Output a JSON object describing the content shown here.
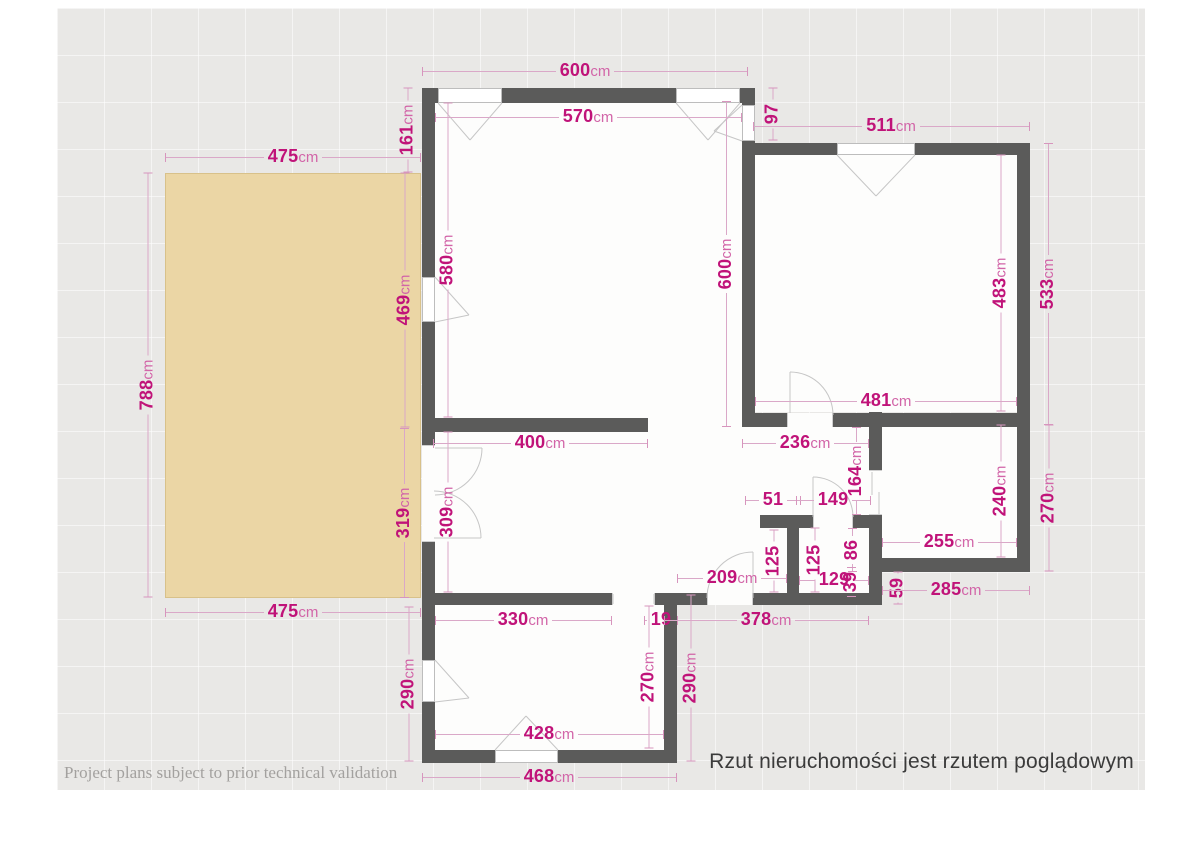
{
  "canvas": {
    "x": 57,
    "y": 8,
    "w": 1088,
    "h": 782
  },
  "colors": {
    "background": "#ffffff",
    "canvas_bg": "#e9e8e6",
    "grid": "rgba(255,255,255,0.55)",
    "wall": "#5b5b5a",
    "room_floor": "#fdfdfc",
    "terrace": "#ebd6a5",
    "dim_number": "#c01379",
    "dim_unit": "#d265a8",
    "dim_line": "#daa8c8",
    "opening_line": "#c6c6c6"
  },
  "terrace": {
    "x": 165,
    "y": 173,
    "w": 256,
    "h": 425
  },
  "floors": [
    {
      "x": 435,
      "y": 103,
      "w": 307,
      "h": 315
    },
    {
      "x": 648,
      "y": 418,
      "w": 94,
      "h": 14
    },
    {
      "x": 435,
      "y": 427,
      "w": 434,
      "h": 166
    },
    {
      "x": 755,
      "y": 155,
      "w": 262,
      "h": 257
    },
    {
      "x": 882,
      "y": 425,
      "w": 135,
      "h": 133
    },
    {
      "x": 435,
      "y": 605,
      "w": 229,
      "h": 145
    }
  ],
  "walls": [
    {
      "x": 422,
      "y": 88,
      "w": 326,
      "h": 15
    },
    {
      "x": 422,
      "y": 88,
      "w": 13,
      "h": 675
    },
    {
      "x": 422,
      "y": 750,
      "w": 255,
      "h": 13
    },
    {
      "x": 664,
      "y": 593,
      "w": 13,
      "h": 170
    },
    {
      "x": 422,
      "y": 418,
      "w": 226,
      "h": 14
    },
    {
      "x": 422,
      "y": 593,
      "w": 190,
      "h": 12
    },
    {
      "x": 655,
      "y": 593,
      "w": 214,
      "h": 12
    },
    {
      "x": 742,
      "y": 88,
      "w": 13,
      "h": 339
    },
    {
      "x": 753,
      "y": 143,
      "w": 277,
      "h": 12
    },
    {
      "x": 1017,
      "y": 143,
      "w": 13,
      "h": 429
    },
    {
      "x": 755,
      "y": 413,
      "w": 262,
      "h": 14
    },
    {
      "x": 869,
      "y": 412,
      "w": 13,
      "h": 193
    },
    {
      "x": 869,
      "y": 558,
      "w": 161,
      "h": 14
    },
    {
      "x": 760,
      "y": 515,
      "w": 53,
      "h": 13
    },
    {
      "x": 853,
      "y": 515,
      "w": 16,
      "h": 13
    },
    {
      "x": 787,
      "y": 515,
      "w": 12,
      "h": 90
    }
  ],
  "windows": [
    {
      "name": "window-living-north-1",
      "x": 438,
      "y": 88,
      "w": 64,
      "h": 15,
      "edge": "bottom",
      "tip": [
        470,
        140
      ]
    },
    {
      "name": "window-living-north-2",
      "x": 676,
      "y": 88,
      "w": 64,
      "h": 15,
      "edge": "bottom",
      "tip": [
        708,
        140
      ]
    },
    {
      "name": "window-living-east",
      "x": 742,
      "y": 105,
      "w": 13,
      "h": 36,
      "edge": "left",
      "tip": [
        714,
        131
      ]
    },
    {
      "name": "window-bedroom-north",
      "x": 837,
      "y": 143,
      "w": 78,
      "h": 12,
      "edge": "bottom",
      "tip": [
        876,
        196
      ]
    },
    {
      "name": "window-living-west",
      "x": 422,
      "y": 277,
      "w": 13,
      "h": 45,
      "edge": "right",
      "tip": [
        469,
        315
      ]
    },
    {
      "name": "window-bottomroom-west",
      "x": 422,
      "y": 660,
      "w": 13,
      "h": 42,
      "edge": "right",
      "tip": [
        469,
        698
      ]
    },
    {
      "name": "window-bottomroom-south",
      "x": 495,
      "y": 750,
      "w": 63,
      "h": 13,
      "edge": "top",
      "tip": [
        526,
        716
      ]
    }
  ],
  "doors": [
    {
      "name": "door-terrace-french-gap",
      "gap": {
        "x": 422,
        "y": 445,
        "w": 13,
        "h": 97,
        "dir": "v"
      },
      "leaf": [
        435,
        448,
        482,
        448
      ],
      "arc": "M482 448 A47 47 0 0 1 435 495"
    },
    {
      "name": "door-terrace-french-leaf2",
      "gap": null,
      "leaf": [
        434,
        538,
        481,
        538
      ],
      "arc": "M481 538 A47 47 0 0 0 434 491"
    },
    {
      "name": "door-bedroom",
      "gap": {
        "x": 787,
        "y": 413,
        "w": 46,
        "h": 14,
        "dir": "h"
      },
      "leaf": [
        790,
        413,
        790,
        372
      ],
      "arc": "M790 372 A43 43 0 0 1 833 415"
    },
    {
      "name": "door-wc",
      "gap": {
        "x": 813,
        "y": 515,
        "w": 40,
        "h": 13,
        "dir": "h"
      },
      "leaf": [
        813,
        517,
        813,
        477
      ],
      "arc": "M813 477 A40 40 0 0 1 853 517"
    },
    {
      "name": "door-entrance",
      "gap": {
        "x": 707,
        "y": 593,
        "w": 46,
        "h": 12,
        "dir": "h"
      },
      "leaf": [
        753,
        598,
        753,
        552
      ],
      "arc": "M707 598 A46 46 0 0 1 753 552"
    },
    {
      "name": "opening-bottom-room",
      "gap": {
        "x": 612,
        "y": 593,
        "w": 43,
        "h": 12,
        "dir": "h"
      },
      "leaf": null,
      "arc": null
    },
    {
      "name": "closet-sliding",
      "gap": {
        "x": 869,
        "y": 470,
        "w": 13,
        "h": 45,
        "dir": "v"
      },
      "leaf": null,
      "arc": null
    }
  ],
  "marks": [
    [
      613,
      594,
      613,
      604
    ],
    [
      654,
      594,
      654,
      604
    ],
    [
      872,
      472,
      872,
      495
    ],
    [
      879,
      492,
      879,
      514
    ]
  ],
  "dimensions": [
    {
      "v": "600",
      "u": "cm",
      "o": "h",
      "x": 585,
      "y": 71,
      "l": 326
    },
    {
      "v": "570",
      "u": "cm",
      "o": "h",
      "x": 588,
      "y": 117,
      "l": 307
    },
    {
      "v": "475",
      "u": "cm",
      "o": "h",
      "x": 293,
      "y": 157,
      "l": 256
    },
    {
      "v": "511",
      "u": "cm",
      "o": "h",
      "x": 891,
      "y": 126,
      "l": 277
    },
    {
      "v": "161",
      "u": "cm",
      "o": "v",
      "x": 407,
      "y": 130,
      "l": 85
    },
    {
      "v": "97",
      "u": "",
      "o": "v",
      "x": 772,
      "y": 114,
      "l": 53
    },
    {
      "v": "580",
      "u": "cm",
      "o": "v",
      "x": 447,
      "y": 260,
      "l": 315
    },
    {
      "v": "469",
      "u": "cm",
      "o": "v",
      "x": 404,
      "y": 300,
      "l": 255
    },
    {
      "v": "600",
      "u": "cm",
      "o": "v",
      "x": 726,
      "y": 264,
      "l": 326
    },
    {
      "v": "483",
      "u": "cm",
      "o": "v",
      "x": 1000,
      "y": 283,
      "l": 257
    },
    {
      "v": "533",
      "u": "cm",
      "o": "v",
      "x": 1048,
      "y": 284,
      "l": 282
    },
    {
      "v": "788",
      "u": "cm",
      "o": "v",
      "x": 147,
      "y": 385,
      "l": 425
    },
    {
      "v": "475",
      "u": "cm",
      "o": "h",
      "x": 293,
      "y": 612,
      "l": 256
    },
    {
      "v": "400",
      "u": "cm",
      "o": "h",
      "x": 540,
      "y": 443,
      "l": 215
    },
    {
      "v": "481",
      "u": "cm",
      "o": "h",
      "x": 886,
      "y": 401,
      "l": 262
    },
    {
      "v": "236",
      "u": "cm",
      "o": "h",
      "x": 805,
      "y": 443,
      "l": 127
    },
    {
      "v": "319",
      "u": "cm",
      "o": "v",
      "x": 404,
      "y": 513,
      "l": 170
    },
    {
      "v": "309",
      "u": "cm",
      "o": "v",
      "x": 447,
      "y": 512,
      "l": 161
    },
    {
      "v": "164",
      "u": "cm",
      "o": "v",
      "x": 856,
      "y": 471,
      "l": 88
    },
    {
      "v": "51",
      "u": "",
      "o": "h",
      "x": 773,
      "y": 500,
      "l": 56
    },
    {
      "v": "149",
      "u": "",
      "o": "h",
      "x": 833,
      "y": 500,
      "l": 75
    },
    {
      "v": "125",
      "u": "",
      "o": "v",
      "x": 773,
      "y": 561,
      "l": 63
    },
    {
      "v": "125",
      "u": "",
      "o": "v",
      "x": 814,
      "y": 560,
      "l": 65
    },
    {
      "v": "86",
      "u": "",
      "o": "v",
      "x": 852,
      "y": 550,
      "l": 44
    },
    {
      "v": "129",
      "u": "",
      "o": "h",
      "x": 834,
      "y": 580,
      "l": 70
    },
    {
      "v": "39",
      "u": "",
      "o": "v",
      "x": 851,
      "y": 582,
      "l": 30
    },
    {
      "v": "209",
      "u": "cm",
      "o": "h",
      "x": 732,
      "y": 578,
      "l": 110
    },
    {
      "v": "59",
      "u": "",
      "o": "v",
      "x": 897,
      "y": 588,
      "l": 33
    },
    {
      "v": "255",
      "u": "cm",
      "o": "h",
      "x": 949,
      "y": 542,
      "l": 135
    },
    {
      "v": "240",
      "u": "cm",
      "o": "v",
      "x": 1000,
      "y": 491,
      "l": 133
    },
    {
      "v": "270",
      "u": "cm",
      "o": "v",
      "x": 1048,
      "y": 498,
      "l": 147
    },
    {
      "v": "285",
      "u": "cm",
      "o": "h",
      "x": 956,
      "y": 590,
      "l": 148
    },
    {
      "v": "330",
      "u": "cm",
      "o": "h",
      "x": 523,
      "y": 620,
      "l": 177
    },
    {
      "v": "19",
      "u": "",
      "o": "h",
      "x": 661,
      "y": 620,
      "l": 34
    },
    {
      "v": "378",
      "u": "cm",
      "o": "h",
      "x": 766,
      "y": 620,
      "l": 205
    },
    {
      "v": "270",
      "u": "cm",
      "o": "v",
      "x": 648,
      "y": 677,
      "l": 143
    },
    {
      "v": "290",
      "u": "cm",
      "o": "v",
      "x": 690,
      "y": 678,
      "l": 167
    },
    {
      "v": "290",
      "u": "cm",
      "o": "v",
      "x": 408,
      "y": 684,
      "l": 155
    },
    {
      "v": "428",
      "u": "cm",
      "o": "h",
      "x": 549,
      "y": 734,
      "l": 229
    },
    {
      "v": "468",
      "u": "cm",
      "o": "h",
      "x": 549,
      "y": 777,
      "l": 255
    }
  ],
  "footer": {
    "left_note": "Project plans subject to prior technical validation",
    "right_note": "Rzut nieruchomości jest rzutem poglądowym"
  }
}
